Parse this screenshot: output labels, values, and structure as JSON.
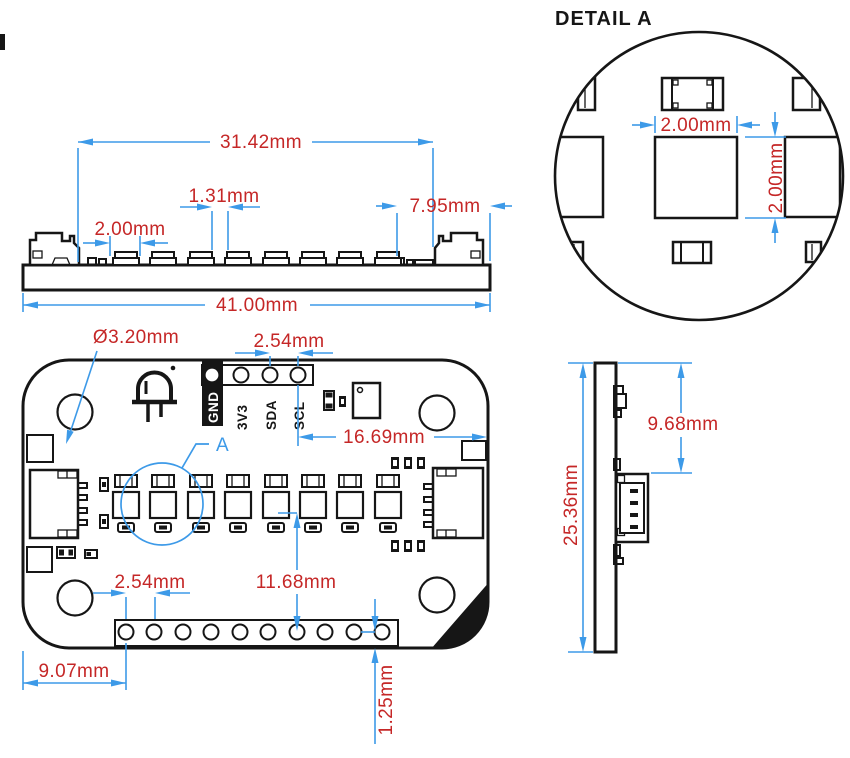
{
  "drawing_title": "PCB dimension drawing",
  "colors": {
    "outline": "#161616",
    "dimension_line": "#3d9ae8",
    "dimension_text": "#c52727",
    "background": "#ffffff"
  },
  "side_view": {
    "dim_inner_span": "31.42mm",
    "dim_led_pitch": "1.31mm",
    "dim_pad_spacing": "2.00mm",
    "dim_right_margin": "7.95mm",
    "dim_board_width": "41.00mm"
  },
  "detail_a": {
    "title": "DETAIL A",
    "dim_width": "2.00mm",
    "dim_height": "2.00mm"
  },
  "top_view": {
    "dim_hole_diameter": "Ø3.20mm",
    "dim_header_pitch_top": "2.54mm",
    "dim_scl_to_edge": "16.69mm",
    "detail_marker": "A",
    "pin_labels": [
      "GND",
      "3V3",
      "SDA",
      "SCL"
    ],
    "dim_header_pitch_bottom": "2.54mm",
    "dim_led_to_header": "11.68mm",
    "dim_edge_to_hole": "9.07mm",
    "dim_hole_to_edge": "1.25mm"
  },
  "right_view": {
    "dim_board_height": "25.36mm",
    "dim_connector_offset": "9.68mm"
  }
}
